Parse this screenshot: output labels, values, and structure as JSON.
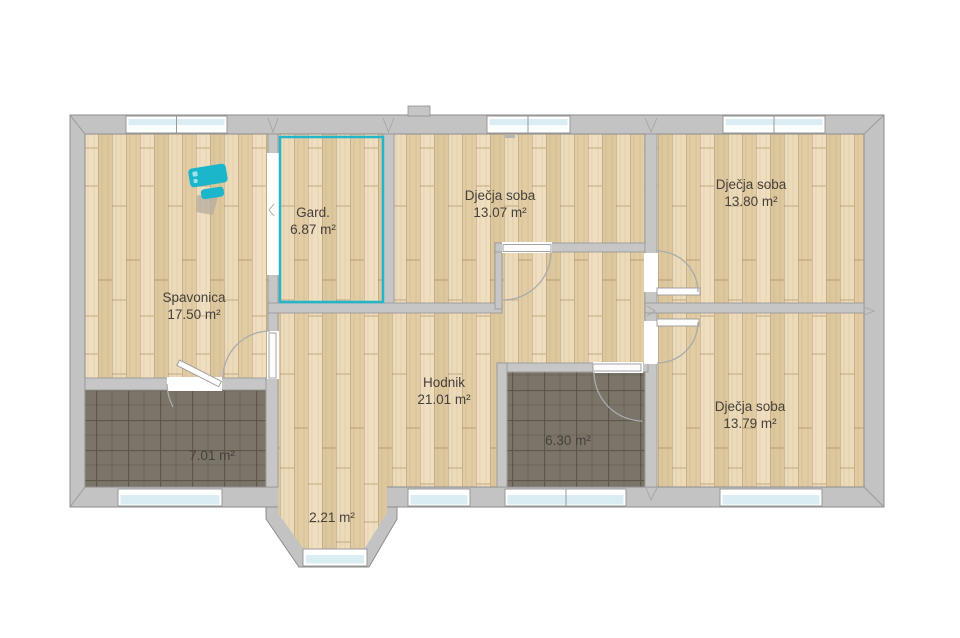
{
  "app": {
    "background": "#ffffff"
  },
  "colors": {
    "wall": "#c6c6c6",
    "wall_outline": "#8d8d8d",
    "wood_floor": "#e7d4af",
    "tile_floor": "#7b7468",
    "selection_highlight": "#23b5c9",
    "furniture_teal": "#1cb6ca",
    "window_glass": "#d9edf3",
    "label_text": "#46413b"
  },
  "units": "m²",
  "rooms": [
    {
      "id": "spavonica",
      "name": "Spavonica",
      "area": "17.50 m²",
      "floor": "wood",
      "highlighted": false
    },
    {
      "id": "garderoba",
      "name": "Gard.",
      "area": "6.87 m²",
      "floor": "wood",
      "highlighted": true
    },
    {
      "id": "djecja-soba-1",
      "name": "Dječja soba",
      "area": "13.07 m²",
      "floor": "wood",
      "highlighted": false
    },
    {
      "id": "djecja-soba-2",
      "name": "Dječja soba",
      "area": "13.80 m²",
      "floor": "wood",
      "highlighted": false
    },
    {
      "id": "hodnik",
      "name": "Hodnik",
      "area": "21.01 m²",
      "floor": "wood",
      "highlighted": false
    },
    {
      "id": "kupaonica-1",
      "name": "",
      "area": "7.01 m²",
      "floor": "tile",
      "highlighted": false
    },
    {
      "id": "kupaonica-2",
      "name": "",
      "area": "6.30 m²",
      "floor": "tile",
      "highlighted": false
    },
    {
      "id": "djecja-soba-3",
      "name": "Dječja soba",
      "area": "13.79 m²",
      "floor": "wood",
      "highlighted": false
    },
    {
      "id": "erker",
      "name": "",
      "area": "2.21 m²",
      "floor": "wood",
      "highlighted": false
    }
  ],
  "furniture": [
    {
      "id": "dresser",
      "room": "spavonica",
      "color": "#1cb6ca"
    }
  ]
}
